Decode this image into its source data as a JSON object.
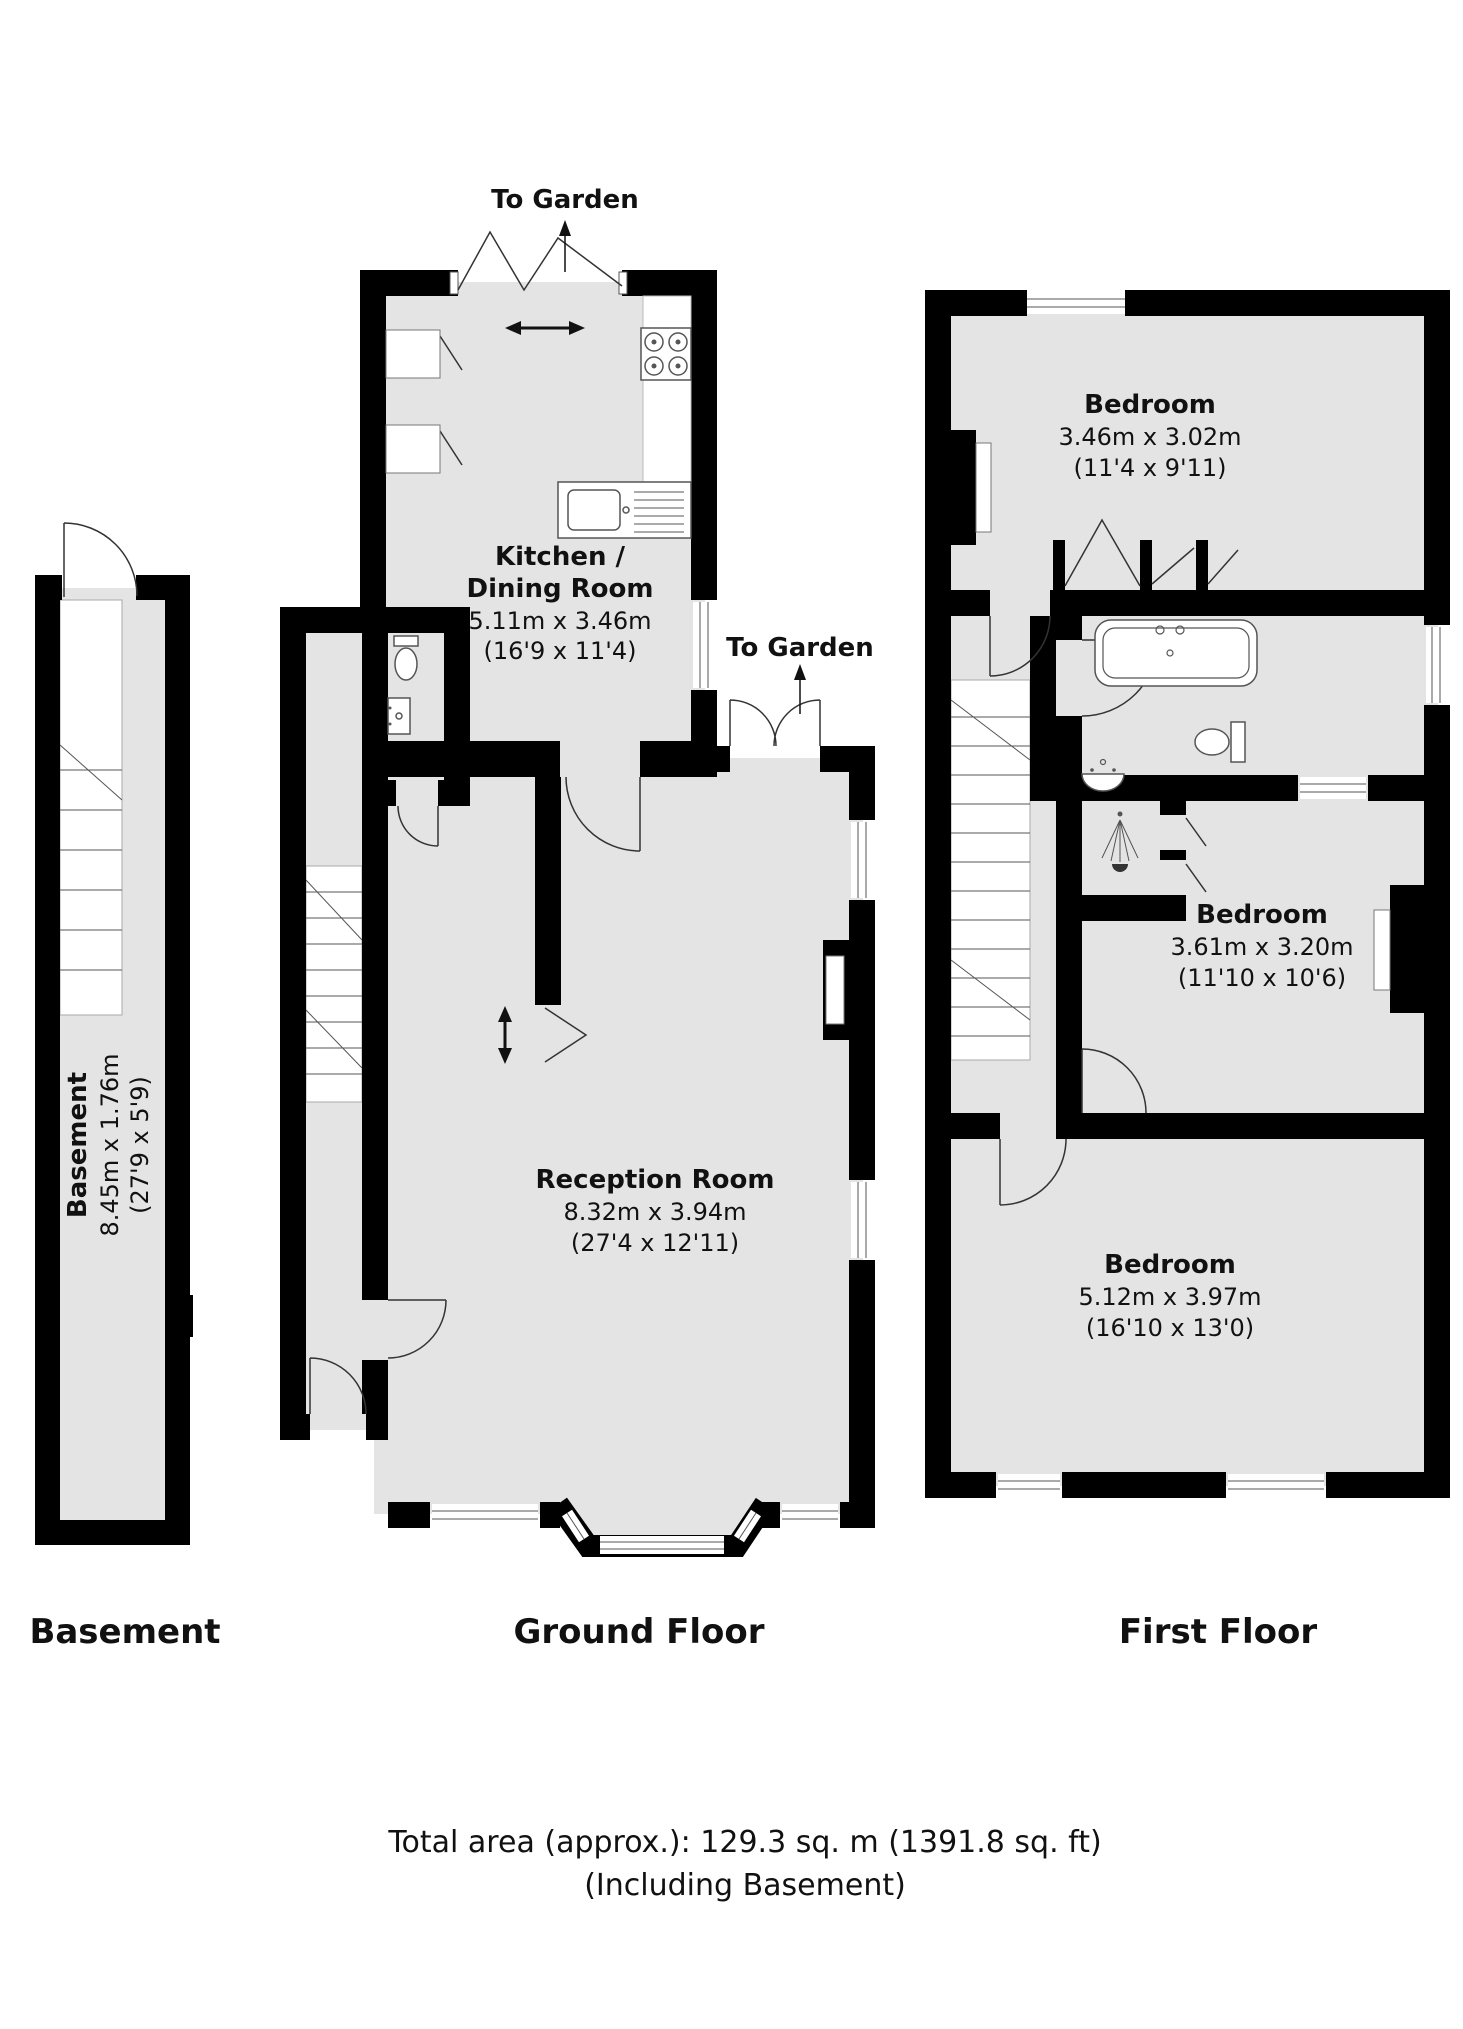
{
  "colors": {
    "wall": "#000000",
    "room_fill": "#e4e4e4",
    "page_bg": "#ffffff"
  },
  "basement": {
    "title": "Basement",
    "room": {
      "name": "Basement",
      "dim_m": "8.45m x 1.76m",
      "dim_ft": "(27'9 x 5'9)"
    }
  },
  "ground": {
    "title": "Ground Floor",
    "to_garden_top": "To Garden",
    "to_garden_side": "To Garden",
    "kitchen": {
      "name1": "Kitchen /",
      "name2": "Dining Room",
      "dim_m": "5.11m x 3.46m",
      "dim_ft": "(16'9 x 11'4)"
    },
    "reception": {
      "name": "Reception Room",
      "dim_m": "8.32m x 3.94m",
      "dim_ft": "(27'4 x 12'11)"
    }
  },
  "first": {
    "title": "First Floor",
    "bedroom_rear": {
      "name": "Bedroom",
      "dim_m": "3.46m x 3.02m",
      "dim_ft": "(11'4 x 9'11)"
    },
    "bedroom_middle": {
      "name": "Bedroom",
      "dim_m": "3.61m x 3.20m",
      "dim_ft": "(11'10 x 10'6)"
    },
    "bedroom_front": {
      "name": "Bedroom",
      "dim_m": "5.12m x 3.97m",
      "dim_ft": "(16'10 x 13'0)"
    }
  },
  "footer": {
    "total_area": "Total area (approx.): 129.3 sq. m (1391.8 sq. ft)",
    "including": "(Including Basement)"
  }
}
